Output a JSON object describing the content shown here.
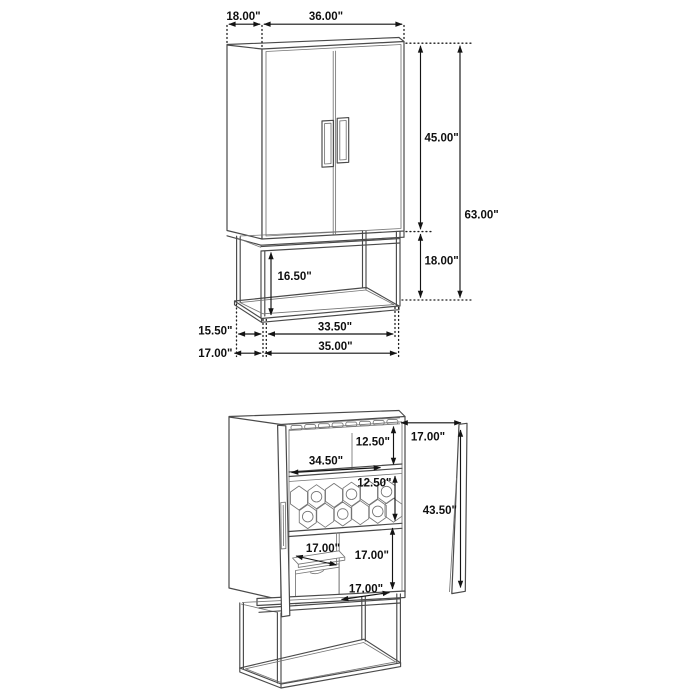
{
  "drawing": {
    "title": "bar cabinet dimension drawing",
    "views": {
      "closed": {
        "dims": {
          "top_depth": "18.00\"",
          "top_width": "36.00\"",
          "door_section_height": "45.00\"",
          "overall_height": "63.00\"",
          "base_opening_height": "16.50\"",
          "base_section_height": "18.00\"",
          "base_inner_depth": "15.50\"",
          "base_outer_depth": "17.00\"",
          "base_inner_width": "33.50\"",
          "base_outer_width": "35.00\""
        }
      },
      "open": {
        "dims": {
          "rack_to_shelf": "12.50\"",
          "interior_width": "34.50\"",
          "shelf_to_rack": "12.50\"",
          "door_panel_width": "17.00\"",
          "door_panel_height": "43.50\"",
          "tray_width": "17.00\"",
          "lower_opening_height": "17.00\"",
          "bottom_opening_width": "17.00\""
        }
      }
    }
  }
}
